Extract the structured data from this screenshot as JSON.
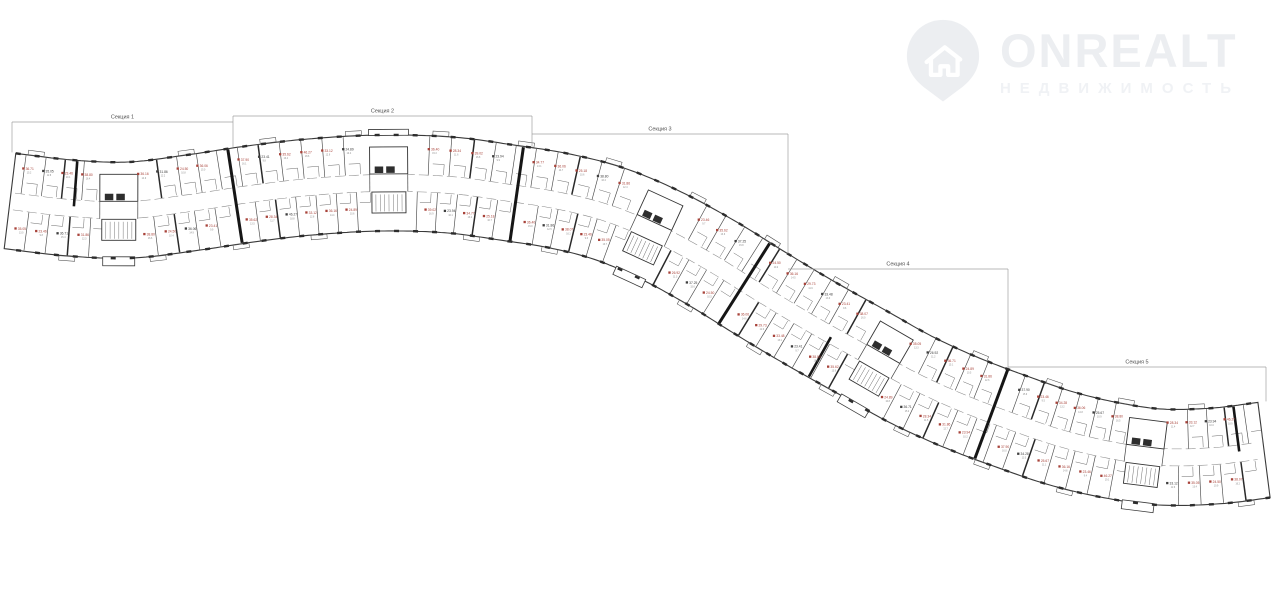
{
  "watermark": {
    "brand": "ONREALT",
    "subtitle": "НЕДВИЖИМОСТЬ"
  },
  "palette": {
    "background": "#ffffff",
    "line": "#3a3a3a",
    "pier": "#2c2c2c",
    "divider": "#4a4a4a",
    "thick_wall": "#161616",
    "corridor": "#8a8a8a",
    "stub": "#5a5a5a",
    "red_label": "#a8433a",
    "dark_label": "#3f3f3f",
    "sub_label": "#8a8a8a",
    "bracket": "#a0a0a0",
    "section_label": "#4f4f4f",
    "watermark_tint": "#eceef1"
  },
  "plan": {
    "centerline": [
      [
        10,
        201
      ],
      [
        70,
        208
      ],
      [
        130,
        210
      ],
      [
        190,
        203
      ],
      [
        250,
        194
      ],
      [
        310,
        187
      ],
      [
        380,
        183
      ],
      [
        450,
        185
      ],
      [
        510,
        193
      ],
      [
        560,
        201
      ],
      [
        610,
        214
      ],
      [
        660,
        235
      ],
      [
        710,
        262
      ],
      [
        760,
        293
      ],
      [
        810,
        323
      ],
      [
        860,
        351
      ],
      [
        910,
        379
      ],
      [
        960,
        402
      ],
      [
        1010,
        421
      ],
      [
        1060,
        438
      ],
      [
        1110,
        450
      ],
      [
        1160,
        457
      ],
      [
        1215,
        456
      ],
      [
        1264,
        450
      ]
    ],
    "half_width": 48,
    "corridor_half_width": 8.5,
    "sections": [
      {
        "label": "Секция 1",
        "x1": 12,
        "x2": 233,
        "y": 122
      },
      {
        "label": "Секция 2",
        "x1": 233,
        "x2": 532,
        "y": 116
      },
      {
        "label": "Секция 3",
        "x1": 532,
        "x2": 788,
        "y": 134
      },
      {
        "label": "Секция 4",
        "x1": 788,
        "x2": 1008,
        "y": 269
      },
      {
        "label": "Секция 5",
        "x1": 1008,
        "x2": 1266,
        "y": 367
      }
    ],
    "cores": [
      {
        "x": 118,
        "entrance": "bottom"
      },
      {
        "x": 388,
        "entrance": "top"
      },
      {
        "x": 652,
        "entrance": "bottom"
      },
      {
        "x": 878,
        "entrance": "bottom"
      },
      {
        "x": 1145,
        "entrance": "bottom"
      }
    ],
    "section_walls": [
      236,
      517,
      745,
      990
    ],
    "partial_walls": [
      [
        72,
        -1
      ],
      [
        833,
        1
      ],
      [
        1240,
        -1
      ]
    ],
    "units": {
      "top": [
        "36.71,15.2,r",
        "35.05,12.8,d",
        "23.46,10.1,r",
        "38.80,16.4,r",
        "36.16,14.9,r",
        "31.86,12.2,d",
        "24.50,10.8,r",
        "36.06,15.0,r",
        "37.90,16.1,r",
        "23.41,9.8,d",
        "35.62,13.4,r",
        "46.27,18.6,r",
        "33.12,12.9,r",
        "24.89,10.4,d",
        "36.40,15.3,r",
        "28.34,11.6,r",
        "39.02,16.8,r",
        "23.94,9.9,d",
        "34.77,13.1,r",
        "36.06,14.7,r",
        "25.18,10.6,r",
        "38.80,16.2,d",
        "31.86,12.4,r",
        "23.46,9.7,r",
        "35.62,13.6,r",
        "37.25,15.8,d",
        "24.50,10.2,r",
        "36.16,14.5,r",
        "29.73,11.9,r",
        "33.48,13.0,d",
        "23.41,9.6,r",
        "38.07,16.0,r",
        "35.05,13.3,r",
        "26.92,11.2,d",
        "36.71,15.1,r",
        "24.89,10.5,r",
        "31.86,12.6,r",
        "37.90,15.9,d",
        "23.46,9.5,r",
        "34.28,13.2,r",
        "36.06,14.8,r",
        "25.67,10.9,d",
        "38.80,16.5,r",
        "28.34,11.4,r",
        "33.12,12.7,r",
        "23.94,10.0,d",
        "46.27,18.9,r",
        "35.62,13.8,r",
        "24.50,10.3,r",
        "36.16,14.6,d",
        "39.02,17.0,r",
        "26.92,11.0,r"
      ],
      "bottom": [
        "35.05,13.0,r",
        "23.46,9.8,r",
        "36.71,15.4,d",
        "31.86,12.3,r",
        "38.80,16.6,r",
        "24.50,10.4,r",
        "36.06,14.9,d",
        "23.41,9.9,r",
        "35.62,13.5,r",
        "28.34,11.7,r",
        "46.27,18.8,d",
        "33.12,12.8,r",
        "36.16,14.4,r",
        "24.89,10.6,r",
        "39.02,16.9,r",
        "23.94,10.1,d",
        "34.77,13.2,r",
        "25.18,10.7,r",
        "36.40,15.0,r",
        "31.86,12.5,d",
        "38.07,16.1,r",
        "23.46,9.6,r",
        "35.05,13.7,r",
        "26.92,11.3,r",
        "37.25,15.6,d",
        "24.50,10.5,r",
        "36.06,14.6,r",
        "29.73,12.0,r",
        "33.48,13.1,r",
        "23.41,9.7,d",
        "38.80,16.3,r",
        "35.62,13.9,r",
        "24.89,10.8,r",
        "36.71,15.2,d",
        "28.34,11.5,r",
        "31.86,12.7,r",
        "23.94,10.2,r",
        "37.90,16.0,r",
        "34.28,13.3,d",
        "25.67,11.1,r",
        "36.16,14.8,r",
        "23.46,9.4,r",
        "46.27,19.1,r",
        "33.12,12.6,d",
        "35.05,13.4,r",
        "24.50,10.9,r",
        "38.07,16.2,r",
        "26.92,11.4,r",
        "36.40,15.5,d",
        "23.41,10.0,r",
        "34.77,13.6,r",
        "39.02,17.2,r"
      ]
    }
  }
}
